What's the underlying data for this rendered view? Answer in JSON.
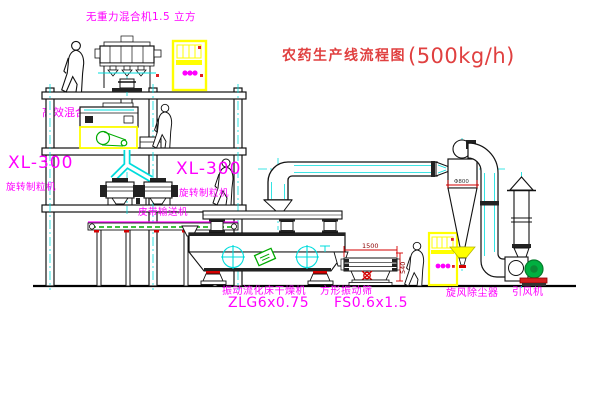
{
  "title": {
    "text": "农药生产线流程图",
    "capacity": "(500kg/h)"
  },
  "labels": {
    "mixer_top": "无重力混合机1.5 立方",
    "mixer_mid": "高效混合机3.5立方",
    "granulator_left_model": "XL-300",
    "granulator_left_name": "旋转制粒机",
    "granulator_mid_model": "XL-300",
    "granulator_mid_name": "旋转制粒机",
    "belt_conveyor": "皮带输送机",
    "dryer_name": "振动流化床干燥机",
    "dryer_model": "ZLG6x0.75",
    "sieve_name": "方形振动筛",
    "sieve_model": "FS0.6x1.5",
    "cyclone_name": "旋风除尘器",
    "fan_name": "引风机"
  },
  "dimensions": {
    "sieve_length": "1500",
    "sieve_height": "540",
    "cyclone_diameter": "Φ800"
  },
  "colors": {
    "label_magenta": "#FF00FF",
    "title_red": "#E04040",
    "cad_yellow": "#FFFF00",
    "cad_cyan": "#00DCDC",
    "cad_green": "#00AA00",
    "dim_red": "#D40000"
  }
}
